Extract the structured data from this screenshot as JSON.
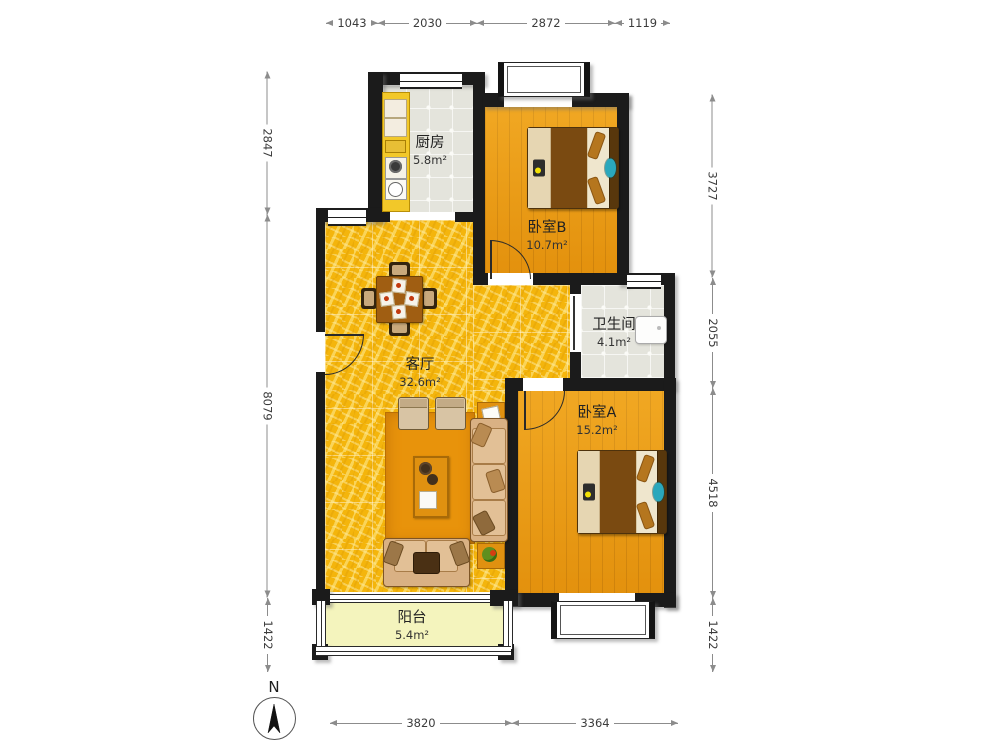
{
  "rooms": {
    "kitchen": {
      "name": "厨房",
      "area": "5.8m²"
    },
    "bedroom_b": {
      "name": "卧室B",
      "area": "10.7m²"
    },
    "bathroom": {
      "name": "卫生间",
      "area": "4.1m²"
    },
    "living": {
      "name": "客厅",
      "area": "32.6m²"
    },
    "bedroom_a": {
      "name": "卧室A",
      "area": "15.2m²"
    },
    "balcony": {
      "name": "阳台",
      "area": "5.4m²"
    }
  },
  "dimensions": {
    "top": [
      "1043",
      "2030",
      "2872",
      "1119"
    ],
    "left": [
      "2847",
      "8079",
      "1422"
    ],
    "right": [
      "3727",
      "2055",
      "4518",
      "1422"
    ],
    "bottom": [
      "3820",
      "3364"
    ]
  },
  "compass": {
    "label": "N"
  },
  "colors": {
    "wall": "#1b1b1b",
    "gold_floor": "#f4b50c",
    "wood_floor": "#ec9b10",
    "tile_floor": "#e4e4dc",
    "balcony_floor": "#f4f4bd",
    "accent_teal": "#2aa7bc",
    "counter_yellow": "#f2c829"
  }
}
